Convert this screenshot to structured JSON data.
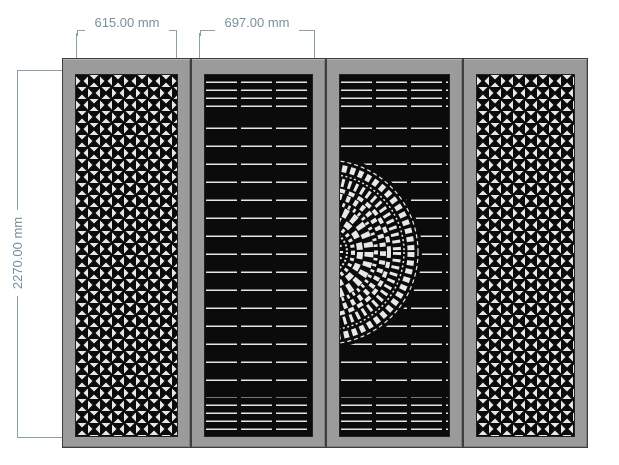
{
  "drawing": {
    "type": "cad-elevation-of-four-panel-decorative-gate",
    "colors": {
      "background": "#ffffff",
      "annotation": "#76909d",
      "frame_gray": "#9b9b9b",
      "panel_black": "#0b0b0b",
      "pattern_white": "#e8e8e8"
    }
  },
  "dimensions": {
    "panel1_width": {
      "label": "615.00 mm"
    },
    "panel2_width": {
      "label": "697.00 mm"
    },
    "total_height": {
      "label": "2270.00 mm"
    }
  },
  "panels": [
    {
      "id": "panel-1",
      "pattern": "geometric-star-grille"
    },
    {
      "id": "panel-2",
      "pattern": "horizontal-slats-with-left-half-mandala"
    },
    {
      "id": "panel-3",
      "pattern": "horizontal-slats-with-right-half-mandala"
    },
    {
      "id": "panel-4",
      "pattern": "geometric-star-grille"
    }
  ]
}
